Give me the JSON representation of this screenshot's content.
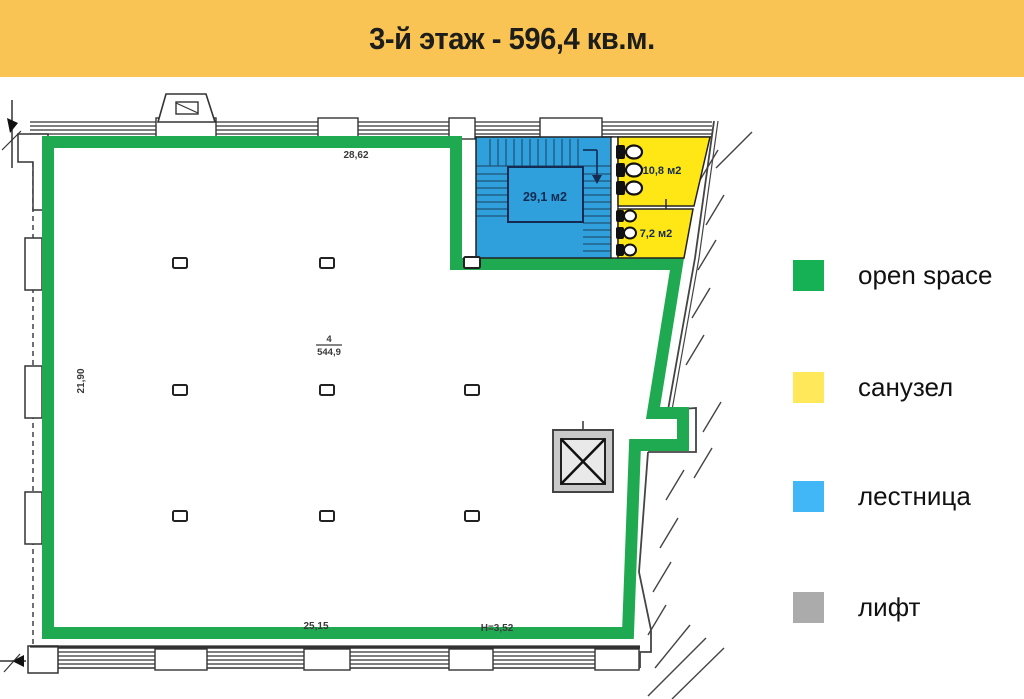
{
  "header": {
    "title": "3-й этаж - 596,4 кв.м.",
    "bg": "#F9C453"
  },
  "plan": {
    "dim_top": "28,62",
    "dim_left": "21,90",
    "dim_bottom": "25,15",
    "dim_height": "H=3,52",
    "room_number": "4",
    "room_area": "544,9",
    "stairs_label": "29,1 м2",
    "wc_large_label": "10,8 м2",
    "wc_small_label": "7,2 м2",
    "colors": {
      "open_space_outline": "#1FA950",
      "stairs_fill": "#2FA0DB",
      "wc_fill": "#FFE715",
      "elevator_fill": "#C9C9C9",
      "elevator_inner": "#E9E9E9",
      "area_label": "#132B52",
      "wall": "#333333"
    }
  },
  "legend": {
    "items": [
      {
        "label": "open space",
        "color": "#17B155"
      },
      {
        "label": "санузел",
        "color": "#FFE95A"
      },
      {
        "label": "лестница",
        "color": "#42B7F8"
      },
      {
        "label": "лифт",
        "color": "#ABABAB"
      }
    ]
  }
}
